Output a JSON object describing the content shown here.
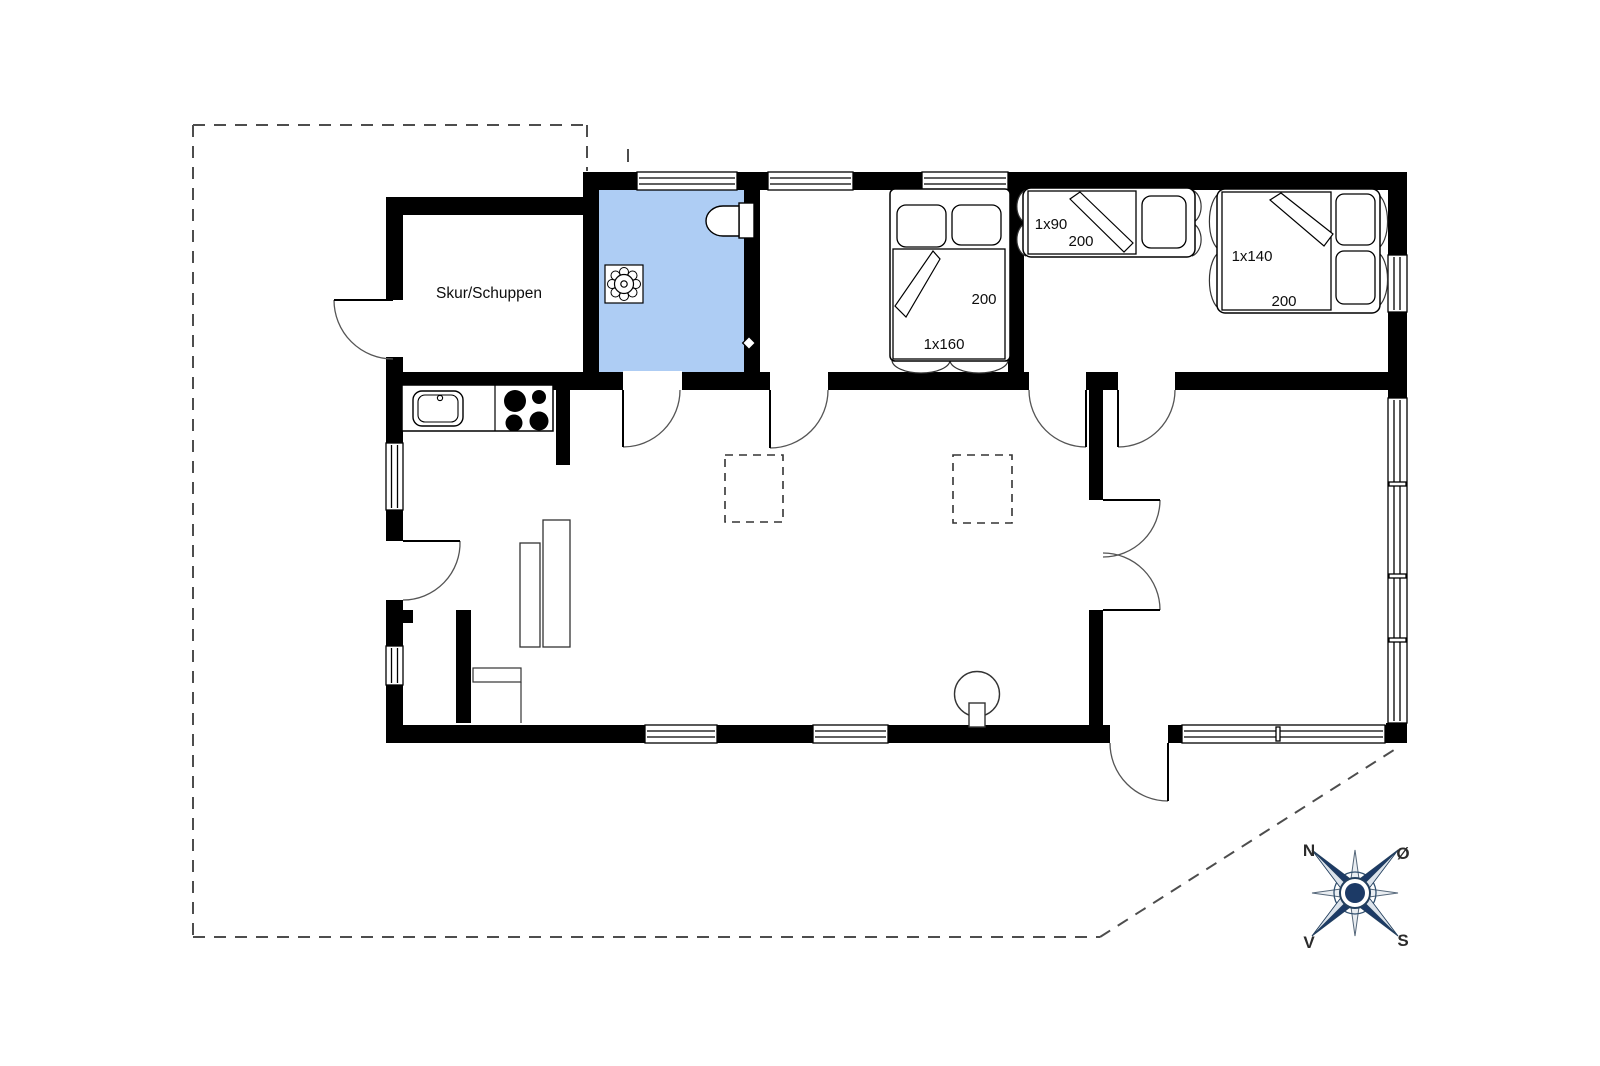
{
  "labels": {
    "shed": "Skur/Schuppen"
  },
  "beds": {
    "double_160": {
      "size": "1x160",
      "length": "200"
    },
    "single_90": {
      "size": "1x90",
      "length": "200"
    },
    "double_140": {
      "size": "1x140",
      "length": "200"
    }
  },
  "compass": {
    "n": "N",
    "e": "Ø",
    "s": "S",
    "v": "V"
  },
  "colors": {
    "wall": "#000000",
    "bathroom": "#aecdf4",
    "compass": "#1c3a66",
    "boundary": "#4d4d4d"
  },
  "icons": {
    "toilet": "toilet-icon",
    "floor_drain": "floor-drain-icon",
    "sink": "kitchen-sink-icon",
    "stove": "cooktop-icon",
    "wood_stove": "wood-stove-icon",
    "compass": "compass-rose-icon"
  }
}
